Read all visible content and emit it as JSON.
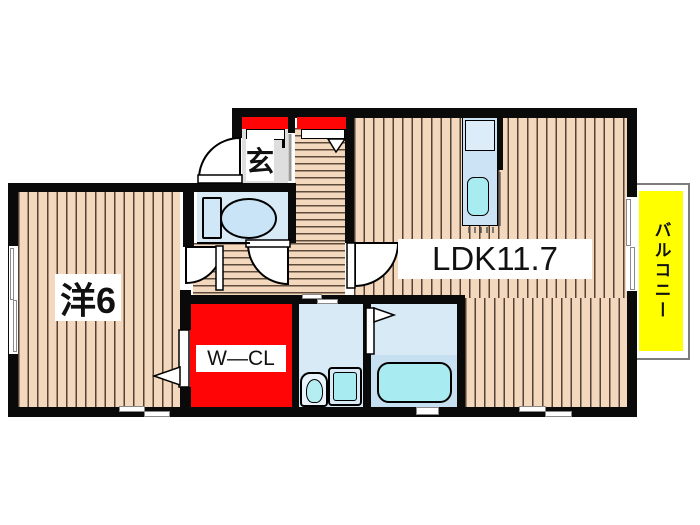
{
  "title": "apartment-floor-plan",
  "labels": {
    "ldk": "LDK11.7",
    "western_room": "洋6",
    "walk_in_closet": "W—CL",
    "entrance": "玄",
    "balcony": "バルコニー"
  },
  "colors": {
    "wall": "#0a0a0a",
    "wood_floor": "#f3d8bd",
    "wet_room_blue": "#d9eaf7",
    "fixture_cyan": "#a8ebf0",
    "storage_red": "#ff0505",
    "balcony_yellow": "#ffff00"
  }
}
